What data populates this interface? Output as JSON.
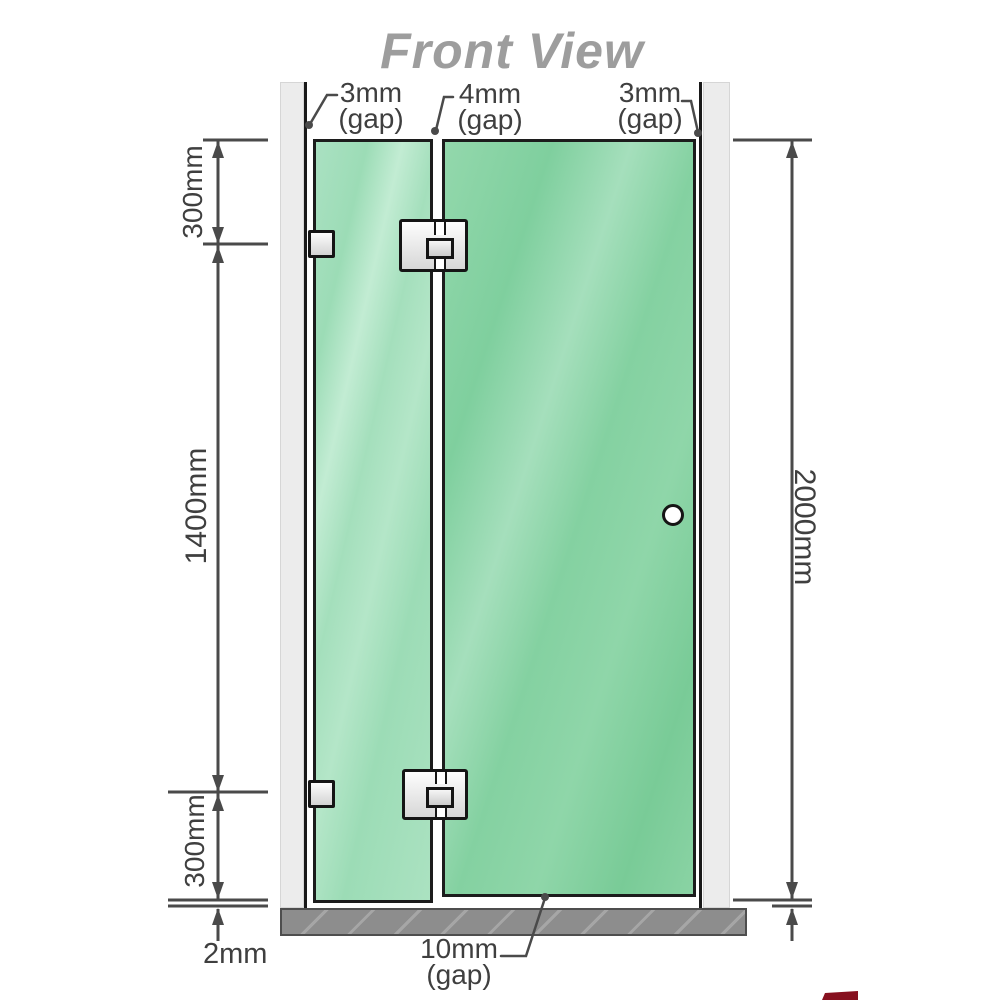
{
  "title": "Front View",
  "annotations": {
    "top_gaps": [
      {
        "value": "3mm",
        "suffix": "(gap)"
      },
      {
        "value": "4mm",
        "suffix": "(gap)"
      },
      {
        "value": "3mm",
        "suffix": "(gap)"
      }
    ],
    "left_dims": [
      "300mm",
      "1400mm",
      "300mm"
    ],
    "right_dim": "2000mm",
    "floor_gap": "2mm",
    "bottom_gap": {
      "value": "10mm",
      "suffix": "(gap)"
    }
  },
  "colors": {
    "title": "#9d9d9d",
    "dimension_lines": "#4a4a4a",
    "label_text": "#3f3f3f",
    "glass_left_panel": "#a6dfbe",
    "glass_door": "#86d2a2",
    "wall_post": "#ececec",
    "floor": "#8d8d8d",
    "hinge_metal": "#e6e6e6",
    "watermark_fragment": "#87101f"
  },
  "components": {
    "wall_posts": 2,
    "glass_panels": 2,
    "glass_to_glass_hinges": 2,
    "wall_brackets": 2,
    "door_handle": "round knob"
  }
}
